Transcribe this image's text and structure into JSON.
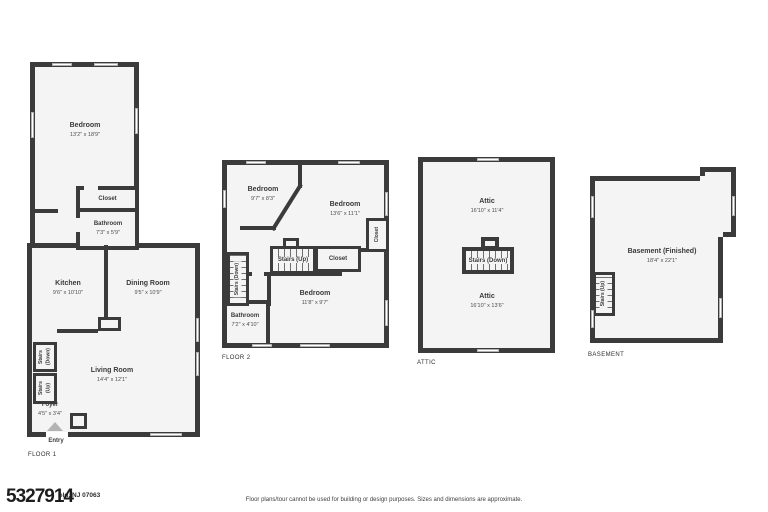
{
  "floor1": {
    "tag": "FLOOR 1",
    "bedroom": {
      "name": "Bedroom",
      "dims": "13'2\" x 18'9\""
    },
    "closet": {
      "name": "Closet"
    },
    "bathroom": {
      "name": "Bathroom",
      "dims": "7'3\" x 5'9\""
    },
    "kitchen": {
      "name": "Kitchen",
      "dims": "9'6\" x 10'10\""
    },
    "dining_room": {
      "name": "Dining Room",
      "dims": "9'5\" x 10'9\""
    },
    "stairs_down": {
      "name": "Stairs (Down)"
    },
    "stairs_up": {
      "name": "Stairs (Up)"
    },
    "living_room": {
      "name": "Living Room",
      "dims": "14'4\" x 12'1\""
    },
    "foyer": {
      "name": "Foyer",
      "dims": "4'5\" x 3'4\""
    },
    "entry": {
      "name": "Entry"
    }
  },
  "floor2": {
    "tag": "FLOOR 2",
    "bedroom_a": {
      "name": "Bedroom",
      "dims": "9'7\" x 8'3\""
    },
    "bedroom_b": {
      "name": "Bedroom",
      "dims": "13'6\" x 11'1\""
    },
    "bedroom_c": {
      "name": "Bedroom",
      "dims": "11'8\" x 9'7\""
    },
    "bathroom": {
      "name": "Bathroom",
      "dims": "7'2\" x 4'10\""
    },
    "closet_side": {
      "name": "Closet"
    },
    "closet_hall": {
      "name": "Closet"
    },
    "stairs_up": {
      "name": "Stairs (Up)"
    },
    "stairs_down": {
      "name": "Stairs (Down)"
    }
  },
  "attic": {
    "tag": "ATTIC",
    "attic_front": {
      "name": "Attic",
      "dims": "16'10\" x 11'4\""
    },
    "attic_back": {
      "name": "Attic",
      "dims": "16'10\" x 13'6\""
    },
    "stairs_down": {
      "name": "Stairs (Down)"
    }
  },
  "basement": {
    "tag": "BASEMENT",
    "main": {
      "name": "Basement (Finished)",
      "dims": "18'4\" x 22'1\""
    },
    "stairs_up": {
      "name": "Stairs (Up)"
    }
  },
  "footer": {
    "watermark_number": "5327914",
    "address_fragment": "eld, NJ 07063",
    "disclaimer": "Floor plans/tour cannot be used for building or design purposes. Sizes and dimensions are approximate."
  },
  "colors": {
    "wall": "#3b3b3b",
    "floor_fill": "#f4f4f4",
    "entry_arrow": "#b3b3b3"
  }
}
